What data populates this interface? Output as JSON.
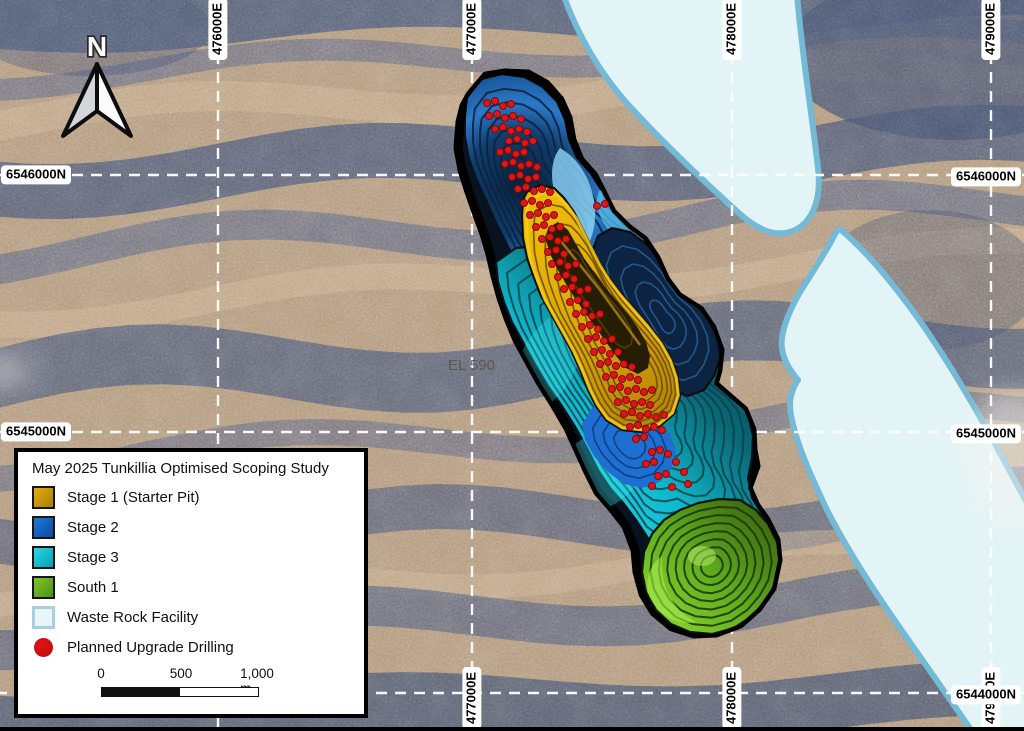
{
  "map": {
    "north_label": "N",
    "region_label": "EL 590",
    "grid": {
      "eastings": [
        {
          "label": "476000E",
          "x": 218,
          "top": true,
          "bottom": false
        },
        {
          "label": "477000E",
          "x": 472,
          "top": true,
          "bottom": true
        },
        {
          "label": "478000E",
          "x": 732,
          "top": true,
          "bottom": true
        },
        {
          "label": "479000E",
          "x": 991,
          "top": true,
          "bottom": true
        }
      ],
      "northings": [
        {
          "label": "6546000N",
          "y": 175,
          "left": true,
          "right": true
        },
        {
          "label": "6545000N",
          "y": 432,
          "left": true,
          "right": true
        },
        {
          "label": "6544000N",
          "y": 693,
          "left": false,
          "right": true
        }
      ]
    }
  },
  "legend": {
    "title": "May 2025 Tunkillia Optimised Scoping Study",
    "items": [
      {
        "label": "Stage 1 (Starter Pit)",
        "swatch": "stage1",
        "color_top": "#e2ac10",
        "color_bottom": "#a87f06"
      },
      {
        "label": "Stage 2",
        "swatch": "stage2",
        "color_top": "#1d7ad8",
        "color_bottom": "#0d47a1"
      },
      {
        "label": "Stage 3",
        "swatch": "stage3",
        "color_top": "#30d6e2",
        "color_bottom": "#009fb4"
      },
      {
        "label": "South 1",
        "swatch": "south1",
        "color_top": "#7cc62c",
        "color_bottom": "#4e8f1a"
      },
      {
        "label": "Waste Rock Facility",
        "swatch": "wrf",
        "color_top": "#e7f6f8",
        "color_bottom": "#e7f6f8"
      },
      {
        "label": "Planned Upgrade Drilling",
        "swatch": "dot",
        "color_top": "#e11212",
        "color_bottom": "#c20d0d"
      }
    ],
    "scale_bar": {
      "tick_labels": [
        "0",
        "500",
        "1,000 m"
      ]
    }
  },
  "colors": {
    "stage1": "#d9a508",
    "stage2": "#1d6fd2",
    "stage3": "#11b8cc",
    "south1": "#5da81e",
    "waste_rock_fill": "#e3f4f6",
    "waste_rock_border": "#74b9d6",
    "drill_dot": "#e31414",
    "pit_outline": "#000000",
    "grid_line": "#ffffff"
  },
  "drill_holes": [
    [
      487,
      103
    ],
    [
      495,
      101
    ],
    [
      503,
      106
    ],
    [
      511,
      104
    ],
    [
      489,
      116
    ],
    [
      497,
      114
    ],
    [
      505,
      118
    ],
    [
      513,
      116
    ],
    [
      521,
      119
    ],
    [
      495,
      129
    ],
    [
      503,
      127
    ],
    [
      511,
      131
    ],
    [
      519,
      129
    ],
    [
      527,
      132
    ],
    [
      509,
      141
    ],
    [
      517,
      139
    ],
    [
      525,
      143
    ],
    [
      533,
      141
    ],
    [
      500,
      152
    ],
    [
      508,
      150
    ],
    [
      516,
      154
    ],
    [
      524,
      152
    ],
    [
      505,
      164
    ],
    [
      513,
      162
    ],
    [
      521,
      166
    ],
    [
      529,
      164
    ],
    [
      537,
      167
    ],
    [
      512,
      177
    ],
    [
      520,
      175
    ],
    [
      528,
      179
    ],
    [
      536,
      177
    ],
    [
      518,
      189
    ],
    [
      526,
      187
    ],
    [
      534,
      191
    ],
    [
      542,
      189
    ],
    [
      550,
      192
    ],
    [
      597,
      206
    ],
    [
      605,
      204
    ],
    [
      524,
      203
    ],
    [
      532,
      201
    ],
    [
      540,
      205
    ],
    [
      548,
      203
    ],
    [
      530,
      215
    ],
    [
      538,
      213
    ],
    [
      546,
      217
    ],
    [
      554,
      215
    ],
    [
      536,
      227
    ],
    [
      544,
      225
    ],
    [
      552,
      229
    ],
    [
      560,
      227
    ],
    [
      542,
      239
    ],
    [
      550,
      237
    ],
    [
      558,
      241
    ],
    [
      566,
      239
    ],
    [
      548,
      252
    ],
    [
      556,
      250
    ],
    [
      564,
      254
    ],
    [
      552,
      264
    ],
    [
      560,
      262
    ],
    [
      568,
      266
    ],
    [
      576,
      264
    ],
    [
      558,
      277
    ],
    [
      566,
      275
    ],
    [
      574,
      279
    ],
    [
      564,
      289
    ],
    [
      572,
      287
    ],
    [
      580,
      291
    ],
    [
      588,
      289
    ],
    [
      570,
      302
    ],
    [
      578,
      300
    ],
    [
      586,
      304
    ],
    [
      576,
      314
    ],
    [
      584,
      312
    ],
    [
      592,
      316
    ],
    [
      600,
      314
    ],
    [
      582,
      327
    ],
    [
      590,
      325
    ],
    [
      598,
      329
    ],
    [
      588,
      339
    ],
    [
      596,
      337
    ],
    [
      604,
      341
    ],
    [
      612,
      339
    ],
    [
      594,
      352
    ],
    [
      602,
      350
    ],
    [
      610,
      354
    ],
    [
      618,
      352
    ],
    [
      600,
      364
    ],
    [
      608,
      362
    ],
    [
      616,
      366
    ],
    [
      624,
      364
    ],
    [
      632,
      367
    ],
    [
      606,
      377
    ],
    [
      614,
      375
    ],
    [
      622,
      379
    ],
    [
      630,
      377
    ],
    [
      638,
      380
    ],
    [
      612,
      389
    ],
    [
      620,
      387
    ],
    [
      628,
      391
    ],
    [
      636,
      389
    ],
    [
      644,
      392
    ],
    [
      652,
      390
    ],
    [
      618,
      402
    ],
    [
      626,
      400
    ],
    [
      634,
      404
    ],
    [
      642,
      402
    ],
    [
      650,
      405
    ],
    [
      624,
      414
    ],
    [
      632,
      412
    ],
    [
      640,
      416
    ],
    [
      648,
      414
    ],
    [
      656,
      417
    ],
    [
      664,
      415
    ],
    [
      630,
      427
    ],
    [
      638,
      425
    ],
    [
      646,
      429
    ],
    [
      654,
      427
    ],
    [
      662,
      430
    ],
    [
      636,
      439
    ],
    [
      644,
      437
    ],
    [
      652,
      452
    ],
    [
      660,
      450
    ],
    [
      668,
      454
    ],
    [
      646,
      464
    ],
    [
      654,
      462
    ],
    [
      676,
      462
    ],
    [
      658,
      476
    ],
    [
      666,
      474
    ],
    [
      684,
      472
    ],
    [
      652,
      486
    ],
    [
      672,
      487
    ],
    [
      688,
      484
    ]
  ]
}
